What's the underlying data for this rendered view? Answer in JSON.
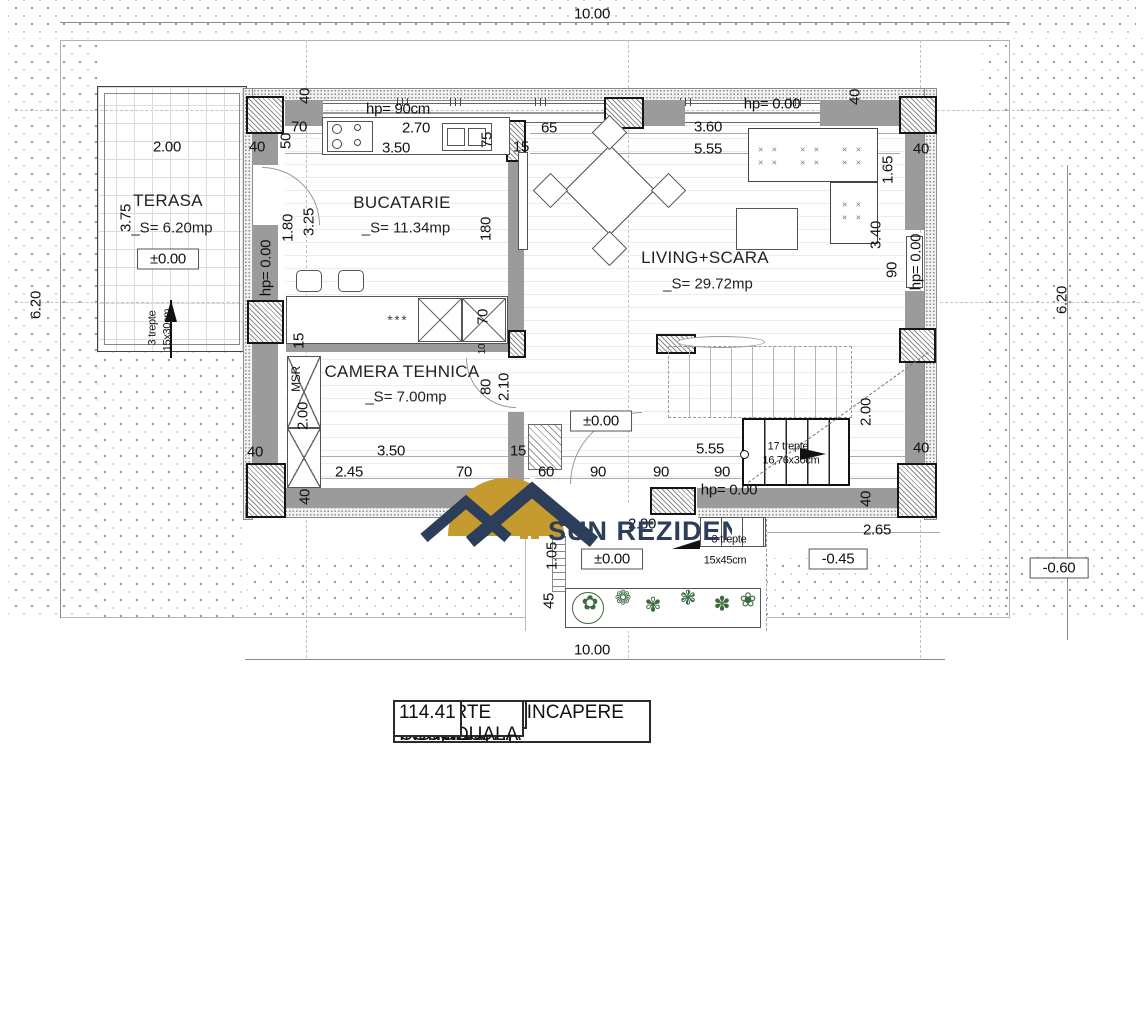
{
  "plan": {
    "rooms": [
      {
        "name": "TERASA",
        "area": "_S= 6.20mp",
        "level": "±0.00"
      },
      {
        "name": "BUCATARIE",
        "area": "_S= 11.34mp"
      },
      {
        "name": "LIVING+SCARA",
        "area": "_S= 29.72mp"
      },
      {
        "name": "CAMERA TEHNICA",
        "area": "_S= 7.00mp"
      }
    ],
    "labels": [
      {
        "t": "10.00",
        "x": 592,
        "y": 14,
        "n": "dim-total-top"
      },
      {
        "t": "10.00",
        "x": 592,
        "y": 650,
        "n": "dim-total-bottom"
      },
      {
        "t": "6.20",
        "x": 36,
        "y": 305,
        "r": -90,
        "n": "dim-total-left"
      },
      {
        "t": "6.20",
        "x": 1062,
        "y": 300,
        "r": -90,
        "n": "dim-total-right"
      },
      {
        "t": "2.00",
        "x": 167,
        "y": 147
      },
      {
        "t": "3.75",
        "x": 126,
        "y": 218,
        "r": -90
      },
      {
        "t": "3 trepte",
        "x": 153,
        "y": 328,
        "r": -90,
        "s": 11,
        "n": "terasa-steps-note"
      },
      {
        "t": "15x30cm",
        "x": 168,
        "y": 330,
        "r": -90,
        "s": 11,
        "n": "terasa-steps-size"
      },
      {
        "t": "40",
        "x": 257,
        "y": 147
      },
      {
        "t": "50",
        "x": 286,
        "y": 141,
        "r": -90
      },
      {
        "t": "70",
        "x": 299,
        "y": 127
      },
      {
        "t": "40",
        "x": 305,
        "y": 96,
        "r": -90
      },
      {
        "t": "hp= 90cm",
        "x": 398,
        "y": 109,
        "n": "parapet-height-kitchen"
      },
      {
        "t": "2.70",
        "x": 416,
        "y": 128
      },
      {
        "t": "3.50",
        "x": 396,
        "y": 148
      },
      {
        "t": "75",
        "x": 487,
        "y": 140,
        "r": -90
      },
      {
        "t": "15",
        "x": 521,
        "y": 147
      },
      {
        "t": "hp= 0.00",
        "x": 266,
        "y": 268,
        "r": -90
      },
      {
        "t": "1.80",
        "x": 288,
        "y": 228,
        "r": -90
      },
      {
        "t": "3.25",
        "x": 309,
        "y": 222,
        "r": -90
      },
      {
        "t": "180",
        "x": 486,
        "y": 229,
        "r": -90
      },
      {
        "t": "70",
        "x": 483,
        "y": 317,
        "r": -90
      },
      {
        "t": "65",
        "x": 549,
        "y": 128
      },
      {
        "t": "3.60",
        "x": 708,
        "y": 127
      },
      {
        "t": "5.55",
        "x": 708,
        "y": 149
      },
      {
        "t": "hp= 0.00",
        "x": 772,
        "y": 104,
        "n": "parapet-height-living"
      },
      {
        "t": "40",
        "x": 855,
        "y": 97,
        "r": -90
      },
      {
        "t": "40",
        "x": 921,
        "y": 149
      },
      {
        "t": "1.65",
        "x": 888,
        "y": 170,
        "r": -90
      },
      {
        "t": "3.40",
        "x": 876,
        "y": 235,
        "r": -90
      },
      {
        "t": "90",
        "x": 892,
        "y": 270,
        "r": -90
      },
      {
        "t": "hp= 0.00",
        "x": 916,
        "y": 262,
        "r": -90,
        "n": "parapet-height-niche"
      },
      {
        "t": "15",
        "x": 299,
        "y": 341,
        "r": -90
      },
      {
        "t": "MSR",
        "x": 296,
        "y": 379,
        "r": -90,
        "s": 12,
        "n": "msr-label"
      },
      {
        "t": "2.00",
        "x": 303,
        "y": 416,
        "r": -90
      },
      {
        "t": "10",
        "x": 483,
        "y": 349,
        "r": -90,
        "s": 10
      },
      {
        "t": "80",
        "x": 486,
        "y": 387,
        "r": -90
      },
      {
        "t": "2.10",
        "x": 504,
        "y": 387,
        "r": -90
      },
      {
        "t": "3.50",
        "x": 391,
        "y": 451
      },
      {
        "t": "2.45",
        "x": 349,
        "y": 472
      },
      {
        "t": "70",
        "x": 464,
        "y": 472
      },
      {
        "t": "15",
        "x": 518,
        "y": 451
      },
      {
        "t": "60",
        "x": 546,
        "y": 472
      },
      {
        "t": "90",
        "x": 598,
        "y": 472
      },
      {
        "t": "90",
        "x": 661,
        "y": 472
      },
      {
        "t": "90",
        "x": 722,
        "y": 472
      },
      {
        "t": "5.55",
        "x": 710,
        "y": 449
      },
      {
        "t": "±0.00",
        "x": 601,
        "y": 421,
        "b": true,
        "n": "level-interior"
      },
      {
        "t": "hp= 0.00",
        "x": 729,
        "y": 490,
        "n": "parapet-height-entrance"
      },
      {
        "t": "17 trepte",
        "x": 788,
        "y": 447,
        "s": 11,
        "n": "stair-steps-note"
      },
      {
        "t": "16,76x30cm",
        "x": 791,
        "y": 461,
        "s": 11,
        "n": "stair-steps-size"
      },
      {
        "t": "2.00",
        "x": 866,
        "y": 412,
        "r": -90
      },
      {
        "t": "40",
        "x": 921,
        "y": 448
      },
      {
        "t": "40",
        "x": 866,
        "y": 499,
        "r": -90
      },
      {
        "t": "40",
        "x": 305,
        "y": 497,
        "r": -90
      },
      {
        "t": "40",
        "x": 255,
        "y": 452
      },
      {
        "t": "2.80",
        "x": 642,
        "y": 524
      },
      {
        "t": "2.65",
        "x": 877,
        "y": 530
      },
      {
        "t": "1.05",
        "x": 552,
        "y": 556,
        "r": -90
      },
      {
        "t": "45",
        "x": 549,
        "y": 601,
        "r": -90
      },
      {
        "t": "3 trepte",
        "x": 729,
        "y": 540,
        "s": 11,
        "n": "exterior-steps-note"
      },
      {
        "t": "15x45cm",
        "x": 725,
        "y": 561,
        "s": 11,
        "n": "exterior-steps-size"
      },
      {
        "t": "±0.00",
        "x": 612,
        "y": 559,
        "b": true,
        "n": "level-walkway"
      },
      {
        "t": "-0.45",
        "x": 838,
        "y": 559,
        "b": true,
        "n": "level-minus-045"
      },
      {
        "t": "-0.60",
        "x": 1059,
        "y": 568,
        "b": true,
        "n": "level-minus-060"
      },
      {
        "t": "***",
        "x": 398,
        "y": 320,
        "c": "stars",
        "n": "kitchen-symbol"
      },
      {
        "t": "× ×",
        "x": 769,
        "y": 150,
        "c": "xs"
      },
      {
        "t": "× ×",
        "x": 769,
        "y": 163,
        "c": "xs"
      },
      {
        "t": "× ×",
        "x": 811,
        "y": 150,
        "c": "xs"
      },
      {
        "t": "× ×",
        "x": 811,
        "y": 163,
        "c": "xs"
      },
      {
        "t": "× ×",
        "x": 853,
        "y": 150,
        "c": "xs"
      },
      {
        "t": "× ×",
        "x": 853,
        "y": 163,
        "c": "xs"
      },
      {
        "t": "× ×",
        "x": 853,
        "y": 205,
        "c": "xs"
      },
      {
        "t": "× ×",
        "x": 853,
        "y": 218,
        "c": "xs"
      }
    ],
    "garden_plants": [
      {
        "g": "✿",
        "x": 590,
        "y": 603
      },
      {
        "g": "❁",
        "x": 623,
        "y": 598
      },
      {
        "g": "✾",
        "x": 653,
        "y": 605
      },
      {
        "g": "❃",
        "x": 688,
        "y": 598
      },
      {
        "g": "✽",
        "x": 722,
        "y": 604
      },
      {
        "g": "❀",
        "x": 748,
        "y": 600
      }
    ]
  },
  "logo": {
    "sun_word": "SUN",
    "rezidential_word": "REZIDENTIAL",
    "gold": "#C59A2F",
    "navy": "#2C3E5A"
  },
  "table": {
    "headers": [
      "NR.",
      "DENUMIRE INCAPERE",
      "S (MP)"
    ],
    "rows": [
      {
        "nr": "1",
        "name": "CAMERA DE ZI",
        "area": "29.72"
      },
      {
        "nr": "2",
        "name": "BUCATARIE",
        "area": "11.34"
      },
      {
        "nr": "3",
        "name": "CAMERA TEHNICA",
        "area": "7.00"
      }
    ],
    "summary": [
      {
        "name": "SUPRAFATA UTILA",
        "area": "48.06"
      },
      {
        "name": "SUPRAFATA CONSTRUITA",
        "area": "62.00"
      },
      {
        "name": "TERASA",
        "area": "6.20"
      },
      {
        "name": "CURTE INDIVIDUALA",
        "area": "114.41"
      }
    ]
  }
}
